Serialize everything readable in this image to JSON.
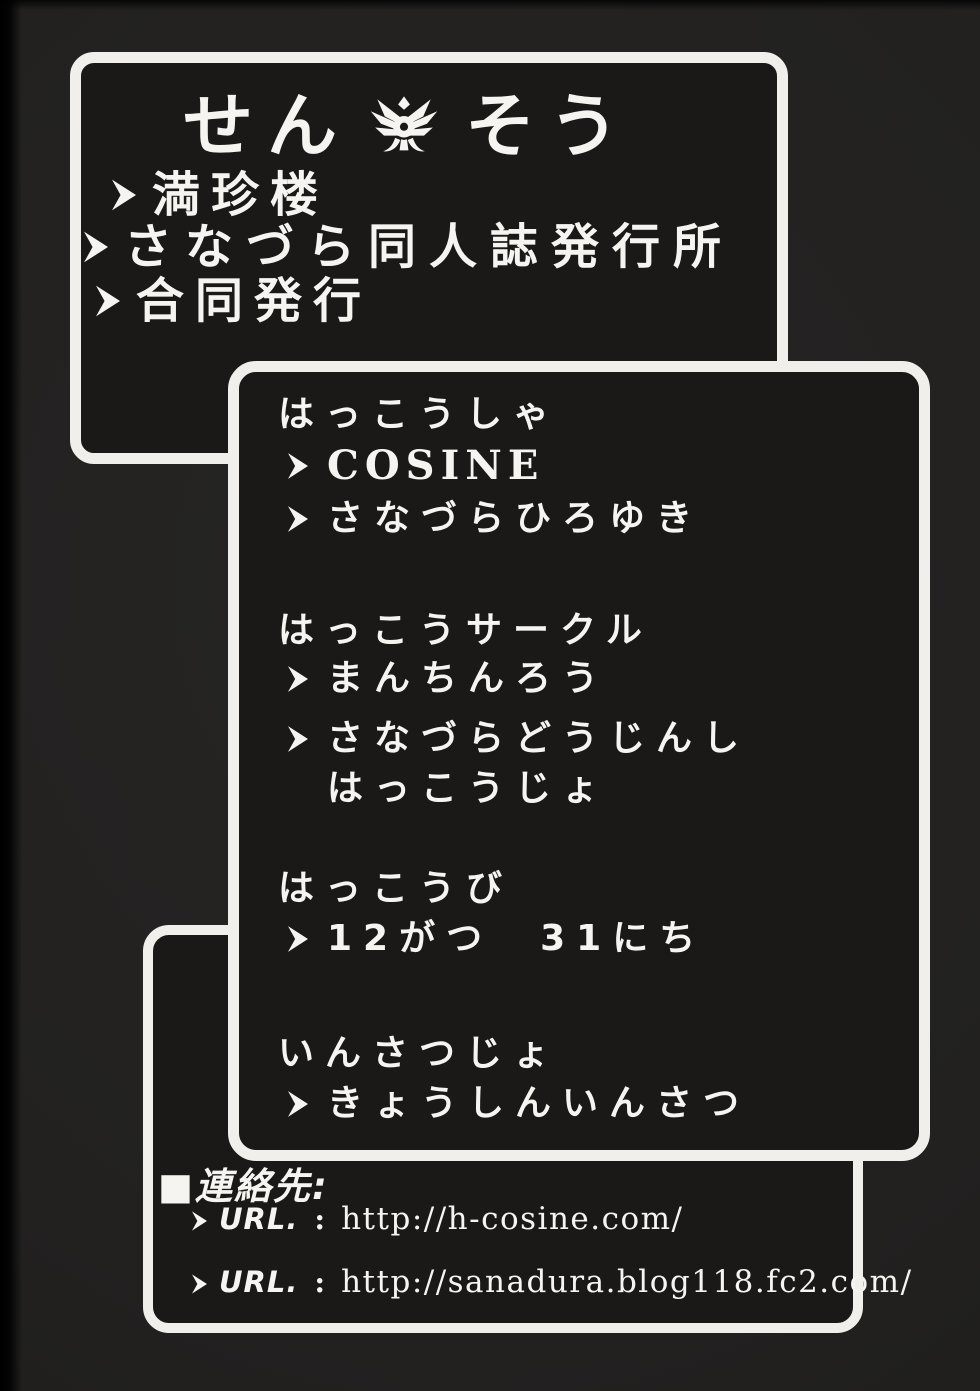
{
  "colors": {
    "page_bg": "#222120",
    "box_bg": "#1a1918",
    "border": "#f0efec",
    "text": "#f5f4f1"
  },
  "title_box": {
    "title_left": "せん",
    "emblem_icon": "winged-crest",
    "title_right": "そう",
    "items": [
      "満珍楼",
      "さなづら同人誌発行所",
      "合同発行"
    ]
  },
  "info_box": {
    "sections": [
      {
        "label": "はっこうしゃ",
        "entries": [
          {
            "lines": [
              "COSINE"
            ]
          },
          {
            "lines": [
              "さなづらひろゆき"
            ]
          }
        ]
      },
      {
        "label": "はっこうサークル",
        "entries": [
          {
            "lines": [
              "まんちんろう"
            ]
          },
          {
            "lines": [
              "さなづらどうじんし",
              "はっこうじょ"
            ]
          }
        ]
      },
      {
        "label": "はっこうび",
        "entries": [
          {
            "lines": [
              "12がつ　31にち"
            ]
          }
        ]
      },
      {
        "label": "いんさつじょ",
        "entries": [
          {
            "lines": [
              "きょうしんいんさつ"
            ]
          }
        ]
      }
    ]
  },
  "contact_box": {
    "heading": "■連絡先:",
    "urls": [
      {
        "label": "URL.",
        "separator": ":",
        "value": "http://h-cosine.com/"
      },
      {
        "label": "URL.",
        "separator": ":",
        "value": "http://sanadura.blog118.fc2.com/"
      }
    ]
  }
}
